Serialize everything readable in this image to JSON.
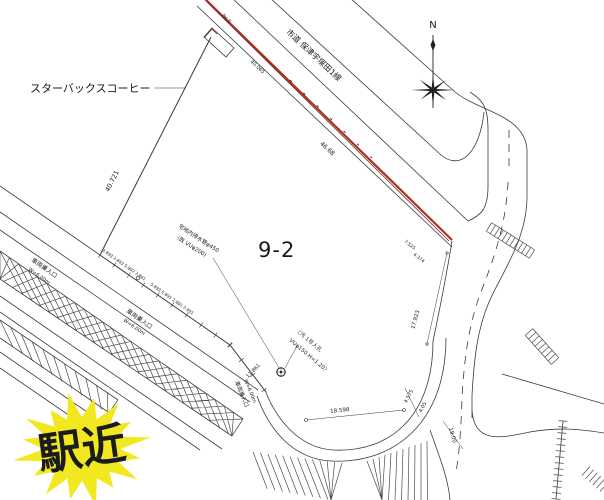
{
  "drawing": {
    "title_parcel": "9-2",
    "landmark": "スターバックスコーヒー",
    "road_name": "市道 保津宇塚田1線",
    "north": "N",
    "badge": {
      "text": "駅近",
      "star_color": "#f2e822",
      "text_color": "#d8160e"
    },
    "entrance": {
      "label": "車両乗入口",
      "width": "W=6.00m"
    },
    "drain_note": {
      "line1": "宅地内排水管φ450",
      "line2": "（既 VUφ200）"
    },
    "manhole_note": {
      "line1": "〈汚 1号人孔",
      "line2": "VUφ150 H=1.20〉"
    },
    "dims": {
      "west": "40.721",
      "northeast": "46.68",
      "top": "40.065",
      "top_point": "No.6",
      "east": "17.923",
      "east_seg1": "7.525",
      "east_seg2": "4.374",
      "curve_chord": "18.598",
      "se_seg1": "4.575",
      "se_seg2": "4.05",
      "south_road": "19.00",
      "pipe_len": "11.861",
      "chain1": "2.893 2.893 5.892 2.891",
      "chain2": "5.893 5.891 2.891 2.891"
    },
    "colors": {
      "boundary_red": "#a93226",
      "line_dark": "#3a3a3a"
    }
  }
}
